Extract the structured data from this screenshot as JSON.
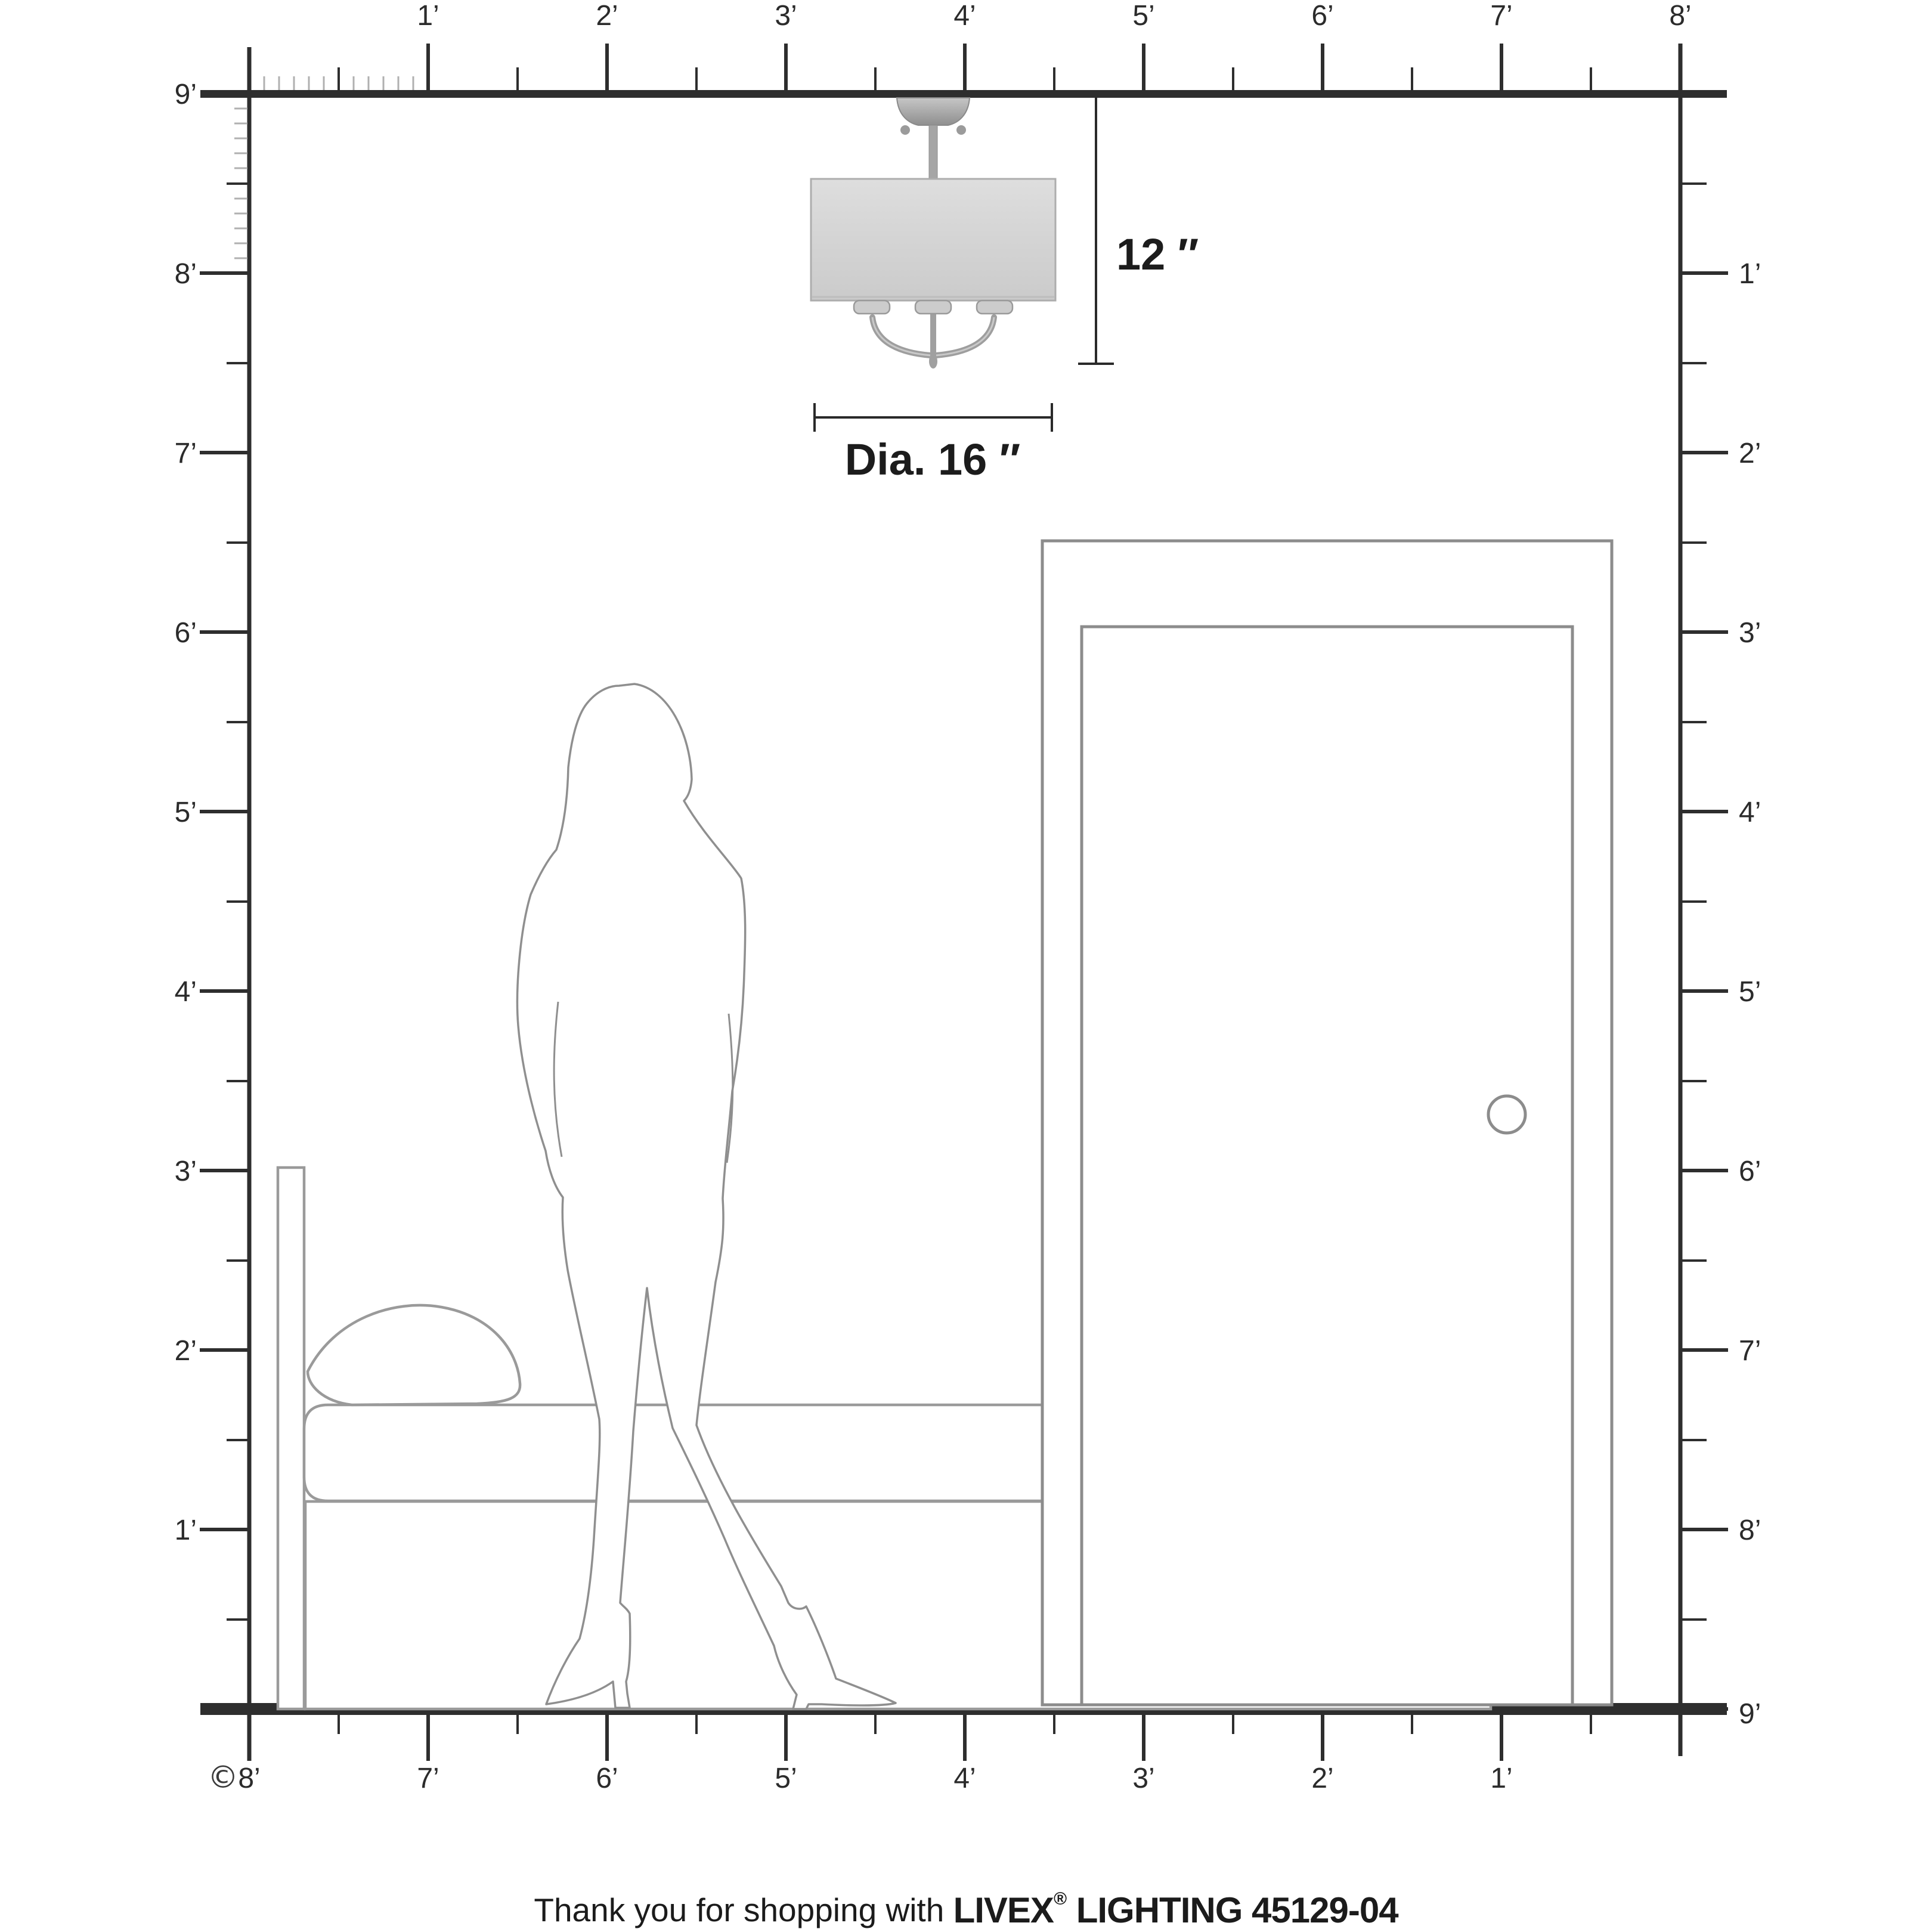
{
  "title": "Livex Lighting fixture room-scale dimension diagram",
  "rulers": {
    "top": [
      "1’",
      "2’",
      "3’",
      "4’",
      "5’",
      "6’",
      "7’",
      "8’"
    ],
    "left": [
      "9’",
      "8’",
      "7’",
      "6’",
      "5’",
      "4’",
      "3’",
      "2’",
      "1’"
    ],
    "right": [
      "1’",
      "2’",
      "3’",
      "4’",
      "5’",
      "6’",
      "7’",
      "8’",
      "9’"
    ],
    "bottom": [
      "8’",
      "7’",
      "6’",
      "5’",
      "4’",
      "3’",
      "2’",
      "1’"
    ]
  },
  "dimensions": {
    "height": "12 ″",
    "diameter": "Dia. 16 ″"
  },
  "copyright": "©",
  "footer": {
    "prefix": "Thank you for shopping with ",
    "brand": "LIVEX",
    "registered": "®",
    "suffix": " LIGHTING 45129-04"
  },
  "scene": {
    "objects": [
      "ceiling-light-fixture",
      "woman-silhouette",
      "bed",
      "door"
    ],
    "room_height_feet": 9,
    "room_width_feet": 8
  },
  "colors": {
    "ink": "#2e2e2e",
    "minor_tick": "#b0b0b0",
    "figure_line": "#8f8f8f",
    "door_line": "#8c8c8c",
    "bed_line": "#9a9a9a",
    "shade_fill": "#d6d6d6",
    "metal": "#a0a0a0",
    "background": "#ffffff"
  }
}
